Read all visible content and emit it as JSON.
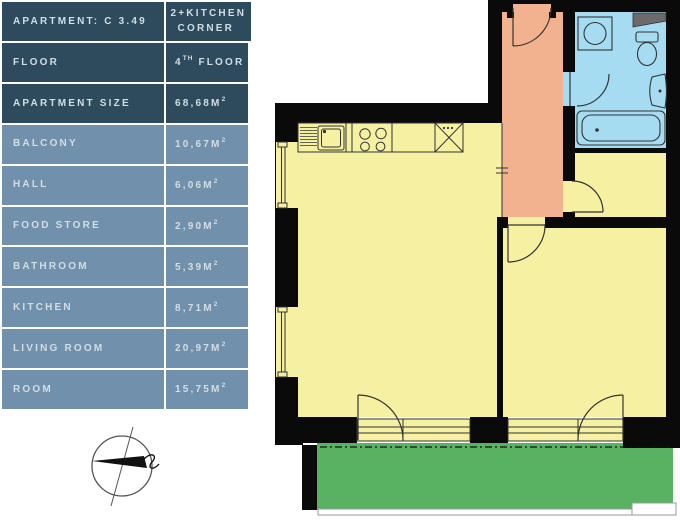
{
  "apartment_table": {
    "colors": {
      "header_bg": "#2d4b5c",
      "row_bg": "#7190ab",
      "text": "#d3dde4",
      "divider": "#ffffff"
    },
    "rows": [
      {
        "label": "Apartment: C 3.49",
        "value_pre": "2+kitchen corner",
        "value_sup": "",
        "value_post": ""
      },
      {
        "label": "Floor",
        "value_pre": "4",
        "value_sup": "th",
        "value_post": "floor"
      },
      {
        "label": "Apartment size",
        "value_pre": "68,68m",
        "value_sup": "2",
        "value_post": ""
      },
      {
        "label": "Balcony",
        "value_pre": "10,67m",
        "value_sup": "2",
        "value_post": ""
      },
      {
        "label": "Hall",
        "value_pre": "6,06m",
        "value_sup": "2",
        "value_post": ""
      },
      {
        "label": "Food store",
        "value_pre": "2,90m",
        "value_sup": "2",
        "value_post": ""
      },
      {
        "label": "Bathroom",
        "value_pre": "5,39m",
        "value_sup": "2",
        "value_post": ""
      },
      {
        "label": "Kitchen",
        "value_pre": "8,71m",
        "value_sup": "2",
        "value_post": ""
      },
      {
        "label": "Living room",
        "value_pre": "20,97m",
        "value_sup": "2",
        "value_post": ""
      },
      {
        "label": "Room",
        "value_pre": "15,75m",
        "value_sup": "2",
        "value_post": ""
      }
    ]
  },
  "floor_plan": {
    "wall_color": "#0a0a0a",
    "outline_color": "#333333",
    "rooms": [
      {
        "name": "kitchen-living-room",
        "color": "#f6f1a2"
      },
      {
        "name": "hall",
        "color": "#f2b18f"
      },
      {
        "name": "bathroom",
        "color": "#a6dcf2"
      },
      {
        "name": "food-store",
        "color": "#f6f1a2"
      },
      {
        "name": "room",
        "color": "#f6f1a2"
      },
      {
        "name": "balcony",
        "color": "#58b261"
      }
    ],
    "fixtures": [
      "kitchen-sink",
      "dish-drainer",
      "stove-burners",
      "fridge-cabinet",
      "washing-machine",
      "toilet",
      "wash-basin",
      "bathtub",
      "shelf",
      "entrance-door",
      "interior-doors",
      "balcony-doors",
      "windows",
      "balcony-railing"
    ]
  },
  "compass": {
    "name": "north-arrow-compass"
  }
}
